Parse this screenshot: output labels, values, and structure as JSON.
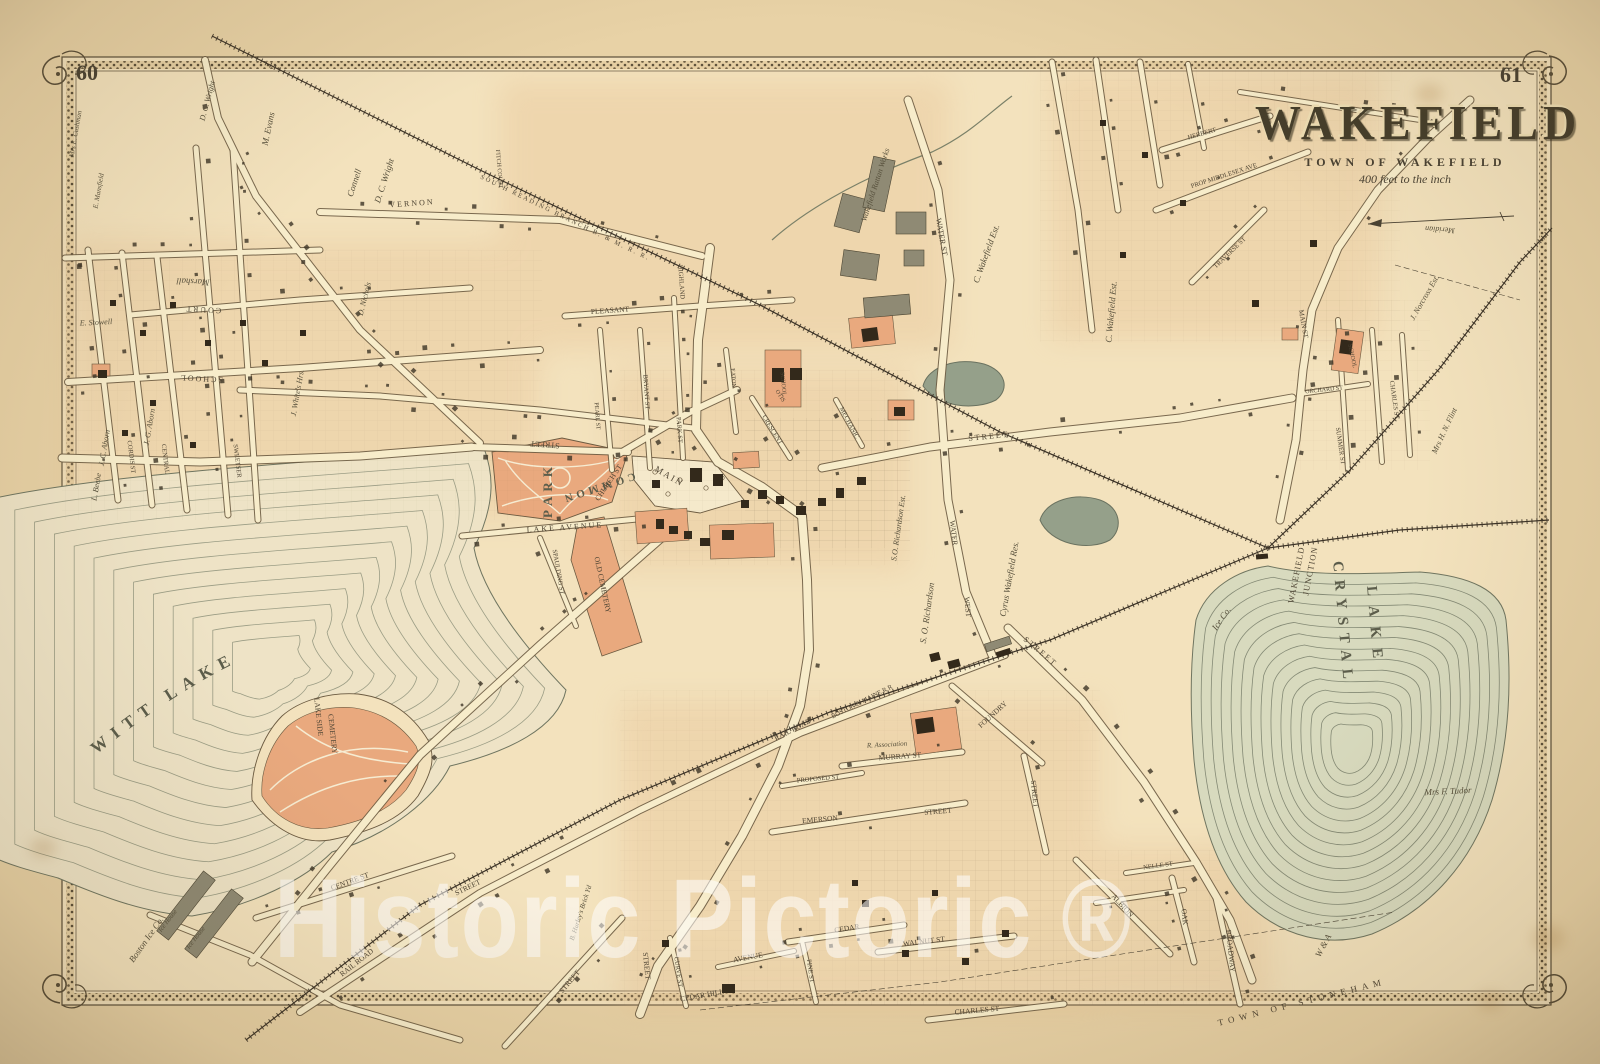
{
  "page": {
    "left_number": "60",
    "right_number": "61"
  },
  "title_block": {
    "title": "WAKEFIELD",
    "subtitle": "TOWN OF WAKEFIELD",
    "scale_note": "400 feet to the inch"
  },
  "watermark": {
    "text": "Historic Pictoric ®"
  },
  "colors": {
    "paper": "#e8d2a6",
    "map_fill": "#f3e2bd",
    "peach_wash": "#e5bd8e",
    "salmon": "#e9a97e",
    "ink": "#4a4233",
    "road_fill": "#f7ecca",
    "road_edge": "#6b5b41",
    "water_line": "#868b74",
    "quannapowitt_fill": "#eee3c6",
    "crystal_fill": "#d8dabe",
    "pond_fill": "#95a08a",
    "building": "#33291b",
    "gray_building": "#8f8a74"
  },
  "labels": [
    {
      "t": "QUANNAPOWITT   LAKE",
      "curve": "qpath",
      "s": 17,
      "ls": 8,
      "c": "lk"
    },
    {
      "t": "CRYSTAL",
      "x": 1342,
      "y": 624,
      "r": 85,
      "s": 15,
      "ls": 8,
      "c": "lk"
    },
    {
      "t": "LAKE",
      "x": 1374,
      "y": 627,
      "r": 85,
      "s": 15,
      "ls": 10,
      "c": "lk"
    },
    {
      "t": "PARK",
      "x": 549,
      "y": 490,
      "r": -90,
      "s": 13,
      "ls": 5,
      "c": "lk"
    },
    {
      "t": "COMMON",
      "x": 598,
      "y": 487,
      "r": 162,
      "s": 11,
      "ls": 4,
      "c": "lk"
    },
    {
      "t": "WAKEFIELD",
      "x": 1297,
      "y": 575,
      "r": -79,
      "s": 8.5,
      "ls": 1,
      "c": "st"
    },
    {
      "t": "JUNCTION",
      "x": 1311,
      "y": 571,
      "r": -79,
      "s": 8.5,
      "ls": 1,
      "c": "st"
    },
    {
      "t": "STREET",
      "x": 545,
      "y": 444,
      "r": 184,
      "s": 8,
      "c": "st"
    },
    {
      "t": "LAKE AVENUE",
      "x": 565,
      "y": 528,
      "r": -4,
      "s": 8,
      "ls": 2,
      "c": "st"
    },
    {
      "t": "CHURCH ST",
      "x": 609,
      "y": 483,
      "r": -56,
      "s": 7.5,
      "c": "st"
    },
    {
      "t": "MAIN",
      "x": 669,
      "y": 477,
      "r": 30,
      "s": 9,
      "ls": 2,
      "c": "st"
    },
    {
      "t": "SPAULDING ST",
      "x": 558,
      "y": 572,
      "r": 80,
      "s": 6.5,
      "c": "st"
    },
    {
      "t": "OLD CEMETERY",
      "x": 602,
      "y": 585,
      "r": 78,
      "s": 7.5,
      "c": "st"
    },
    {
      "t": "LAKE SIDE",
      "x": 318,
      "y": 717,
      "r": 84,
      "s": 7.5,
      "c": "st"
    },
    {
      "t": "CEMETERY",
      "x": 332,
      "y": 734,
      "r": 84,
      "s": 7.5,
      "c": "st"
    },
    {
      "t": "WATER ST",
      "x": 941,
      "y": 237,
      "r": 80,
      "s": 8,
      "c": "st"
    },
    {
      "t": "WATER",
      "x": 953,
      "y": 533,
      "r": 83,
      "s": 7.5,
      "c": "st"
    },
    {
      "t": "WEST",
      "x": 967,
      "y": 607,
      "r": 85,
      "s": 7.5,
      "c": "st"
    },
    {
      "t": "STREET",
      "x": 989,
      "y": 437,
      "r": -6,
      "s": 8,
      "ls": 2,
      "c": "st"
    },
    {
      "t": "STREET",
      "x": 1040,
      "y": 652,
      "r": 40,
      "s": 8,
      "ls": 2,
      "c": "st"
    },
    {
      "t": "MURRAY ST",
      "x": 900,
      "y": 757,
      "r": -4,
      "s": 7.5,
      "c": "st"
    },
    {
      "t": "PROPOSED ST",
      "x": 818,
      "y": 779,
      "r": -5,
      "s": 6.5,
      "c": "st"
    },
    {
      "t": "EMERSON",
      "x": 820,
      "y": 820,
      "r": -5,
      "s": 7.5,
      "c": "st"
    },
    {
      "t": "STREET",
      "x": 938,
      "y": 812,
      "r": -5,
      "s": 7.5,
      "c": "st"
    },
    {
      "t": "RAIL ROAD",
      "x": 793,
      "y": 730,
      "r": -28,
      "s": 7.5,
      "c": "st"
    },
    {
      "t": "BOSTON & MAINE R R",
      "x": 862,
      "y": 702,
      "r": -27,
      "s": 6.5,
      "c": "st"
    },
    {
      "t": "FOUNDRY",
      "x": 993,
      "y": 715,
      "r": -42,
      "s": 7.5,
      "c": "st"
    },
    {
      "t": "STREET",
      "x": 1034,
      "y": 794,
      "r": 84,
      "s": 7.5,
      "c": "st"
    },
    {
      "t": "CENTRE ST",
      "x": 350,
      "y": 882,
      "r": -20,
      "s": 7.5,
      "c": "st"
    },
    {
      "t": "RAIL ROAD",
      "x": 357,
      "y": 963,
      "r": -38,
      "s": 7.5,
      "c": "st"
    },
    {
      "t": "STREET",
      "x": 468,
      "y": 888,
      "r": -26,
      "s": 7.5,
      "c": "st"
    },
    {
      "t": "STREET",
      "x": 570,
      "y": 982,
      "r": -50,
      "s": 7.5,
      "c": "st"
    },
    {
      "t": "STREET",
      "x": 646,
      "y": 966,
      "r": 84,
      "s": 7.5,
      "c": "st"
    },
    {
      "t": "CEDAR HILL",
      "x": 702,
      "y": 996,
      "r": -10,
      "s": 7.5,
      "c": "st"
    },
    {
      "t": "CURVE ST",
      "x": 678,
      "y": 972,
      "r": 82,
      "s": 6.5,
      "c": "st"
    },
    {
      "t": "AVENUE",
      "x": 748,
      "y": 958,
      "r": -10,
      "s": 7.5,
      "c": "st"
    },
    {
      "t": "PINE ST",
      "x": 810,
      "y": 971,
      "r": 82,
      "s": 6.5,
      "c": "st"
    },
    {
      "t": "CEDAR",
      "x": 847,
      "y": 929,
      "r": -9,
      "s": 7.5,
      "c": "st"
    },
    {
      "t": "WALNUT ST",
      "x": 924,
      "y": 942,
      "r": -7,
      "s": 7.5,
      "c": "st"
    },
    {
      "t": "CHARLES ST",
      "x": 977,
      "y": 1011,
      "r": -5,
      "s": 7.5,
      "c": "st"
    },
    {
      "t": "ALBION",
      "x": 1122,
      "y": 906,
      "r": 47,
      "s": 7.5,
      "c": "st"
    },
    {
      "t": "NELLE ST",
      "x": 1158,
      "y": 866,
      "r": -8,
      "s": 6.5,
      "c": "st"
    },
    {
      "t": "OAK",
      "x": 1184,
      "y": 917,
      "r": 84,
      "s": 7.5,
      "c": "st"
    },
    {
      "t": "BROADWAY",
      "x": 1230,
      "y": 951,
      "r": 84,
      "s": 7.5,
      "c": "st"
    },
    {
      "t": "TOWN OF STONEHAM",
      "x": 1302,
      "y": 1003,
      "r": -14,
      "s": 9,
      "ls": 5,
      "c": "st"
    },
    {
      "t": "MECHANIC",
      "x": 849,
      "y": 423,
      "r": 62,
      "s": 6.5,
      "c": "st"
    },
    {
      "t": "SCHOOL",
      "x": 201,
      "y": 378,
      "r": 183,
      "s": 8,
      "ls": 2,
      "c": "st"
    },
    {
      "t": "COURT",
      "x": 203,
      "y": 309,
      "r": 183,
      "s": 8,
      "ls": 2,
      "c": "st"
    },
    {
      "t": "CORDIS ST",
      "x": 131,
      "y": 457,
      "r": 83,
      "s": 6.5,
      "c": "st"
    },
    {
      "t": "CENTRAL",
      "x": 165,
      "y": 459,
      "r": 83,
      "s": 6.5,
      "c": "st"
    },
    {
      "t": "SWEETSER",
      "x": 237,
      "y": 461,
      "r": 83,
      "s": 6.5,
      "c": "st"
    },
    {
      "t": "VERNON",
      "x": 412,
      "y": 204,
      "r": -4,
      "s": 8,
      "ls": 2,
      "c": "st"
    },
    {
      "t": "FITCH COURT",
      "x": 499,
      "y": 169,
      "r": 85,
      "s": 6,
      "c": "st"
    },
    {
      "t": "SOUTH READING BRANCH B. & M. R. R.",
      "x": 565,
      "y": 218,
      "r": 26,
      "s": 6.5,
      "ls": 2,
      "c": "st"
    },
    {
      "t": "HERBERT",
      "x": 1202,
      "y": 134,
      "r": -16,
      "s": 6.5,
      "c": "st"
    },
    {
      "t": "PROP MIDDLESEX AVE",
      "x": 1224,
      "y": 176,
      "r": -18,
      "s": 6.5,
      "c": "st"
    },
    {
      "t": "TRAVERSE ST",
      "x": 1230,
      "y": 253,
      "r": -44,
      "s": 6.5,
      "c": "st"
    },
    {
      "t": "PLEASANT",
      "x": 610,
      "y": 311,
      "r": -4,
      "s": 7.5,
      "c": "st"
    },
    {
      "t": "HIGHLAND",
      "x": 681,
      "y": 282,
      "r": 86,
      "s": 6.5,
      "c": "st"
    },
    {
      "t": "BRYANT ST",
      "x": 646,
      "y": 392,
      "r": 86,
      "s": 6.5,
      "c": "st"
    },
    {
      "t": "PARK ST",
      "x": 679,
      "y": 430,
      "r": 86,
      "s": 6.5,
      "c": "st"
    },
    {
      "t": "EATON",
      "x": 733,
      "y": 378,
      "r": 86,
      "s": 6,
      "c": "st"
    },
    {
      "t": "CRESCENT",
      "x": 772,
      "y": 430,
      "r": 58,
      "s": 6.5,
      "c": "st"
    },
    {
      "t": "OTIS",
      "x": 780,
      "y": 396,
      "r": 58,
      "s": 6,
      "c": "st"
    },
    {
      "t": "PEARL ST",
      "x": 597,
      "y": 416,
      "r": 86,
      "s": 6,
      "c": "st"
    },
    {
      "t": "SCHOOL",
      "x": 783,
      "y": 384,
      "r": 85,
      "s": 6,
      "c": "st"
    },
    {
      "t": "MAIN ST",
      "x": 1303,
      "y": 324,
      "r": 80,
      "s": 7,
      "c": "st"
    },
    {
      "t": "CHARLES ST",
      "x": 1394,
      "y": 400,
      "r": 82,
      "s": 6.5,
      "c": "st"
    },
    {
      "t": "ORCHARD ST",
      "x": 1324,
      "y": 390,
      "r": -6,
      "s": 6,
      "c": "st"
    },
    {
      "t": "SUMMER ST",
      "x": 1340,
      "y": 446,
      "r": 82,
      "s": 6.5,
      "c": "st"
    },
    {
      "t": "SCHOOL",
      "x": 1352,
      "y": 356,
      "r": 78,
      "s": 6,
      "c": "st"
    },
    {
      "t": "Ice Co.",
      "x": 1222,
      "y": 619,
      "r": -55,
      "s": 9,
      "c": "es"
    },
    {
      "t": "Mrs F. Tudor",
      "x": 1448,
      "y": 792,
      "r": -3,
      "s": 9,
      "c": "es"
    },
    {
      "t": "W & A",
      "x": 1324,
      "y": 946,
      "r": -62,
      "s": 9,
      "c": "es"
    },
    {
      "t": "Wakefield Rattan Works",
      "x": 876,
      "y": 185,
      "r": -72,
      "s": 8,
      "c": "es"
    },
    {
      "t": "C. Wakefield Est.",
      "x": 987,
      "y": 254,
      "r": -70,
      "s": 9,
      "c": "es"
    },
    {
      "t": "C. Wakefield Est.",
      "x": 1112,
      "y": 312,
      "r": -85,
      "s": 9,
      "c": "es"
    },
    {
      "t": "Cyrus Wakefield Res.",
      "x": 1010,
      "y": 579,
      "r": -80,
      "s": 9,
      "c": "es"
    },
    {
      "t": "S.O. Richardson Est.",
      "x": 899,
      "y": 528,
      "r": -82,
      "s": 8,
      "c": "es"
    },
    {
      "t": "S. O. Richardson",
      "x": 928,
      "y": 613,
      "r": -82,
      "s": 9,
      "c": "es"
    },
    {
      "t": "B. Hurley's Brick Yd",
      "x": 581,
      "y": 913,
      "r": -72,
      "s": 7,
      "c": "es"
    },
    {
      "t": "R. Association",
      "x": 887,
      "y": 745,
      "r": -3,
      "s": 7,
      "c": "es"
    },
    {
      "t": "Marshall",
      "x": 193,
      "y": 281,
      "r": 183,
      "s": 9,
      "c": "es"
    },
    {
      "t": "E. Stowell",
      "x": 96,
      "y": 323,
      "r": -3,
      "s": 8,
      "c": "es"
    },
    {
      "t": "J. C. Aborn",
      "x": 105,
      "y": 448,
      "r": -80,
      "s": 8,
      "c": "es"
    },
    {
      "t": "J. G. Aborn",
      "x": 150,
      "y": 427,
      "r": -80,
      "s": 8,
      "c": "es"
    },
    {
      "t": "J. White's Hrs.",
      "x": 298,
      "y": 393,
      "r": -80,
      "s": 8,
      "c": "es"
    },
    {
      "t": "D. Nichols",
      "x": 365,
      "y": 299,
      "r": -76,
      "s": 8,
      "c": "es"
    },
    {
      "t": "L. Beebe",
      "x": 97,
      "y": 487,
      "r": -80,
      "s": 8,
      "c": "es"
    },
    {
      "t": "Mrs E. Cushman",
      "x": 76,
      "y": 134,
      "r": -80,
      "s": 7,
      "c": "es"
    },
    {
      "t": "D. C. Wright",
      "x": 208,
      "y": 101,
      "r": -75,
      "s": 8,
      "c": "es"
    },
    {
      "t": "E. Mansfield",
      "x": 99,
      "y": 191,
      "r": -80,
      "s": 7,
      "c": "es"
    },
    {
      "t": "M. Evans",
      "x": 269,
      "y": 129,
      "r": -78,
      "s": 9,
      "c": "es"
    },
    {
      "t": "Connell",
      "x": 355,
      "y": 183,
      "r": -72,
      "s": 9,
      "c": "es"
    },
    {
      "t": "D. C. Wright",
      "x": 385,
      "y": 181,
      "r": -72,
      "s": 9,
      "c": "es"
    },
    {
      "t": "J. Norcross Est.",
      "x": 1425,
      "y": 298,
      "r": -60,
      "s": 8,
      "c": "es"
    },
    {
      "t": "Mrs H. N. Flint",
      "x": 1445,
      "y": 431,
      "r": -65,
      "s": 8,
      "c": "es"
    },
    {
      "t": "Boston Ice Co.",
      "x": 147,
      "y": 940,
      "r": -55,
      "s": 9,
      "c": "es"
    },
    {
      "t": "Ice House",
      "x": 168,
      "y": 921,
      "r": -52,
      "s": 6.5,
      "c": "es"
    },
    {
      "t": "Ice House",
      "x": 196,
      "y": 938,
      "r": -52,
      "s": 6.5,
      "c": "es"
    },
    {
      "t": "Meridian",
      "x": 1440,
      "y": 229,
      "r": 184,
      "s": 8,
      "c": "es"
    }
  ]
}
